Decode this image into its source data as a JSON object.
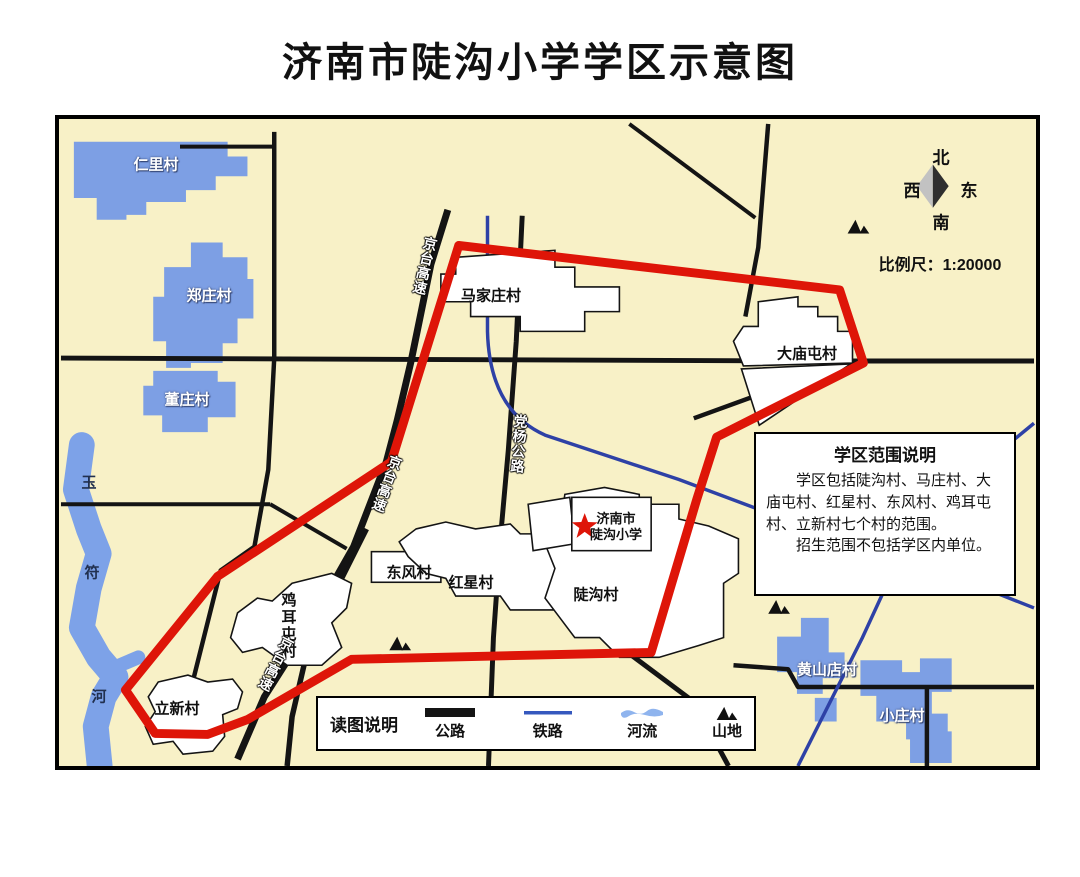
{
  "title": "济南市陡沟小学学区示意图",
  "compass": {
    "north": "北",
    "south": "南",
    "west": "西",
    "east": "东"
  },
  "scale_label": "比例尺：1:20000",
  "school": {
    "line1": "济南市",
    "line2": "陡沟小学"
  },
  "villages": {
    "outside": [
      "仁里村",
      "郑庄村",
      "董庄村",
      "黄山店村",
      "小庄村"
    ],
    "inside": [
      "马家庄村",
      "大庙屯村",
      "东风村",
      "红星村",
      "陡沟村",
      "鸡耳屯村",
      "立新村"
    ]
  },
  "roads": {
    "jingtai": "京台高速",
    "dangyang": "党杨公路"
  },
  "river": {
    "chars": [
      "玉",
      "符",
      "河"
    ]
  },
  "info_box": {
    "title": "学区范围说明",
    "p1": "学区包括陡沟村、马庄村、大庙屯村、红星村、东风村、鸡耳屯村、立新村七个村的范围。",
    "p2": "招生范围不包括学区内单位。"
  },
  "legend": {
    "title": "读图说明",
    "items": [
      {
        "label": "公路",
        "symbol": "road-line"
      },
      {
        "label": "铁路",
        "symbol": "railway-line"
      },
      {
        "label": "河流",
        "symbol": "river-shape"
      },
      {
        "label": "山地",
        "symbol": "mountain-icon"
      }
    ]
  },
  "colors": {
    "map_background": "#F8F1C7",
    "district_boundary_red": "#DE1508",
    "road_black": "#141414",
    "railway_blue": "#2E41A6",
    "water_blue": "#7DA2E8",
    "village_area_white": "#FFFFFF"
  }
}
